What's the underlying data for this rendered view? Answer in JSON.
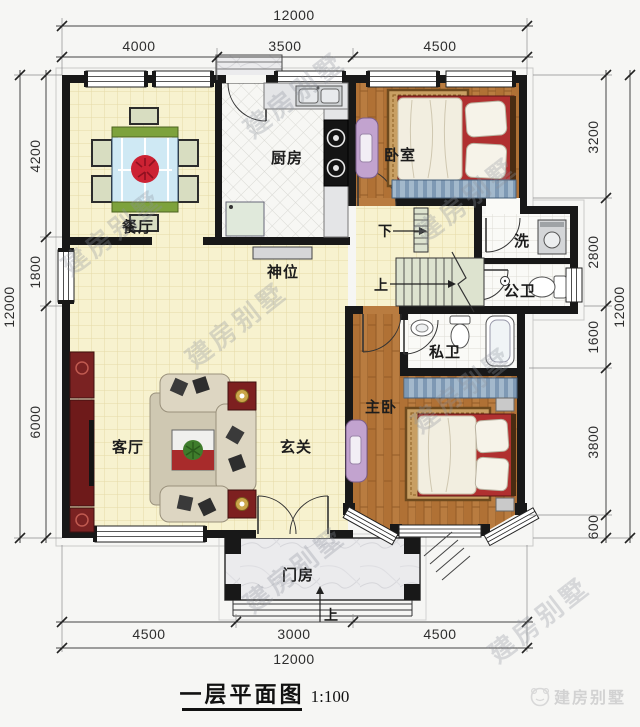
{
  "title": {
    "name": "一层平面图",
    "scale": "1:100"
  },
  "brand": {
    "name": "建房别墅"
  },
  "watermark": {
    "text": "建房别墅"
  },
  "dimensions": {
    "top": {
      "total": "12000",
      "segments": [
        "4000",
        "3500",
        "4500"
      ]
    },
    "bottom": {
      "total": "12000",
      "segments": [
        "4500",
        "3000",
        "4500"
      ]
    },
    "left": {
      "total": "12000",
      "segments": [
        "4200",
        "1800",
        "6000"
      ]
    },
    "right": {
      "total": "12000",
      "segments": [
        "3200",
        "2800",
        "1600",
        "3800",
        "600"
      ]
    }
  },
  "plan": {
    "rooms": {
      "dining": "餐厅",
      "kitchen": "厨房",
      "bedroom": "卧室",
      "shrine": "神位",
      "laundry": "洗",
      "public_bath": "公卫",
      "private_bath": "私卫",
      "master_bedroom": "主卧",
      "living": "客厅",
      "foyer": "玄关",
      "porch": "门房"
    },
    "stairs": {
      "down": "下",
      "up": "上"
    },
    "entry_step_label": "上"
  },
  "colors": {
    "wall": "#181818",
    "floor_yellow": "#f7f2cf",
    "wood": "#b97c40",
    "tile_white": "#fafaf7",
    "accent_red": "#a82b2b",
    "table_blue": "#cfe9f4",
    "brand_gray": "#d2d2d2"
  }
}
